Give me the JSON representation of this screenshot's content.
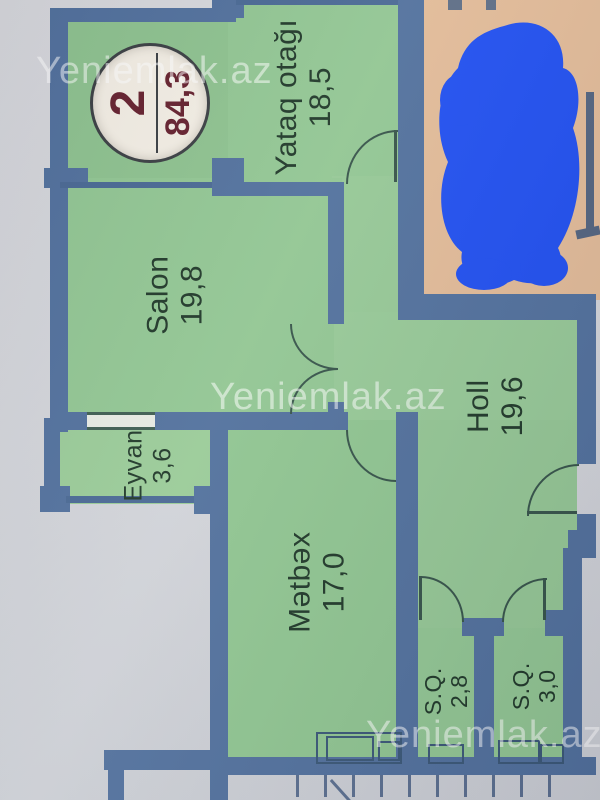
{
  "plan": {
    "badge": {
      "number": "2",
      "area": "84,3"
    },
    "watermark": "Yeniemlak.az",
    "rooms": [
      {
        "name": "Yataq otağı",
        "area": "18,5"
      },
      {
        "name": "Salon",
        "area": "19,8"
      },
      {
        "name": "Holl",
        "area": "19,6"
      },
      {
        "name": "Eyvan",
        "area": "3,6"
      },
      {
        "name": "Mətbəx",
        "area": "17,0"
      },
      {
        "name": "S.Q.",
        "area": "2,8"
      },
      {
        "name": "S.Q.",
        "area": "3,0"
      }
    ],
    "colors": {
      "wall": "#52719d",
      "room_fill": "#92c693",
      "adjacent_fill": "#e2bb98",
      "scribble": "#2150f0",
      "badge_text": "#66222f",
      "label_text": "#21392a",
      "paper": "#d2d4d9",
      "watermark_text": "rgba(255,255,255,0.52)"
    }
  }
}
